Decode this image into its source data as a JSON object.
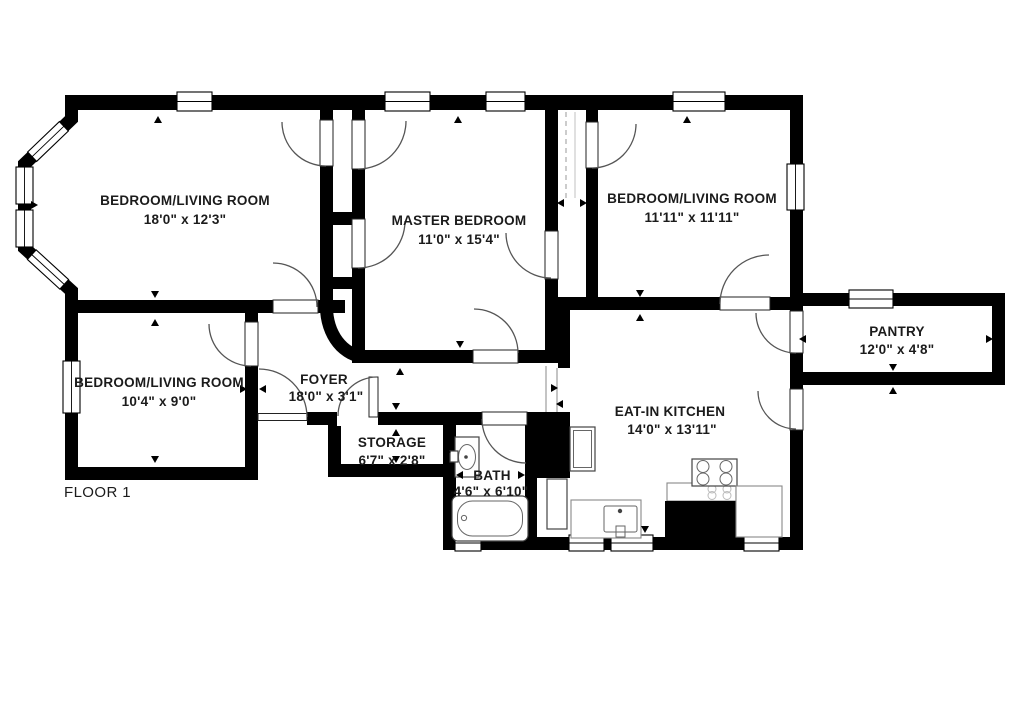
{
  "title": "FLOOR 1",
  "rooms": [
    {
      "id": "bedroom-living-1",
      "name": "BEDROOM/LIVING ROOM",
      "dims": "18'0\" x 12'3\""
    },
    {
      "id": "master-bedroom",
      "name": "MASTER BEDROOM",
      "dims": "11'0\" x 15'4\""
    },
    {
      "id": "bedroom-living-2",
      "name": "BEDROOM/LIVING ROOM",
      "dims": "11'11\" x 11'11\""
    },
    {
      "id": "pantry",
      "name": "PANTRY",
      "dims": "12'0\" x 4'8\""
    },
    {
      "id": "bedroom-living-3",
      "name": "BEDROOM/LIVING ROOM",
      "dims": "10'4\" x 9'0\""
    },
    {
      "id": "foyer",
      "name": "FOYER",
      "dims": "18'0\" x 3'1\""
    },
    {
      "id": "storage",
      "name": "STORAGE",
      "dims": "6'7\" x 2'8\""
    },
    {
      "id": "bath",
      "name": "BATH",
      "dims": "4'6\" x 6'10\""
    },
    {
      "id": "eat-in-kitchen",
      "name": "EAT-IN KITCHEN",
      "dims": "14'0\" x 13'11\""
    }
  ],
  "fixtures": [
    "bathtub",
    "pedestal-sink",
    "kitchen-sink",
    "stove",
    "oven",
    "refrigerator",
    "counter",
    "closet-rod"
  ],
  "colors": {
    "wall": "#000000",
    "background": "#ffffff",
    "text": "#1b1b1b",
    "door_arc": "#555555"
  }
}
